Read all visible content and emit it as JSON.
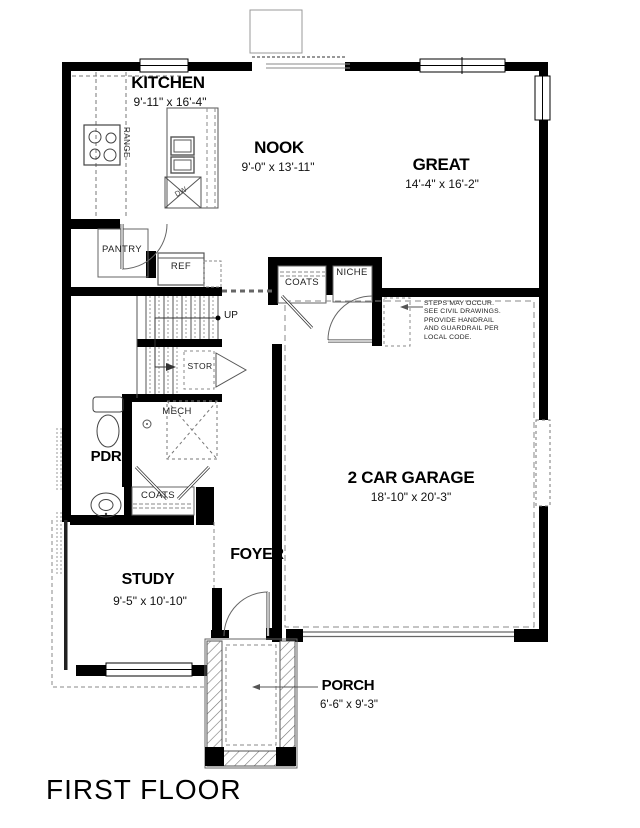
{
  "title": "FIRST FLOOR",
  "rooms": {
    "kitchen": {
      "name": "KITCHEN",
      "dims": "9'-11\" x 16'-4\""
    },
    "nook": {
      "name": "NOOK",
      "dims": "9'-0\" x 13'-11\""
    },
    "great": {
      "name": "GREAT",
      "dims": "14'-4\" x 16'-2\""
    },
    "garage": {
      "name": "2 CAR GARAGE",
      "dims": "18'-10\" x 20'-3\""
    },
    "study": {
      "name": "STUDY",
      "dims": "9'-5\" x 10'-10\""
    },
    "porch": {
      "name": "PORCH",
      "dims": "6'-6\" x 9'-3\""
    },
    "foyer": {
      "name": "FOYER"
    },
    "pdr": {
      "name": "PDR"
    },
    "pantry": {
      "name": "PANTRY"
    },
    "mech": {
      "name": "MECH"
    },
    "stor": {
      "name": "STOR"
    },
    "niche": {
      "name": "NICHE"
    },
    "coats_hall": {
      "name": "COATS"
    },
    "coats_foyer": {
      "name": "COATS"
    }
  },
  "fixtures": {
    "ref": "REF",
    "range": "RANGE",
    "dw": "DW",
    "up": "UP"
  },
  "note": {
    "line1": "STEPS MAY OCCUR.",
    "line2": "SEE CIVIL DRAWINGS.",
    "line3": "PROVIDE HANDRAIL",
    "line4": "AND GUARDRAIL PER",
    "line5": "LOCAL CODE."
  },
  "colors": {
    "wall": "#000000",
    "line": "#555555",
    "dashed": "#777777",
    "background": "#ffffff"
  }
}
